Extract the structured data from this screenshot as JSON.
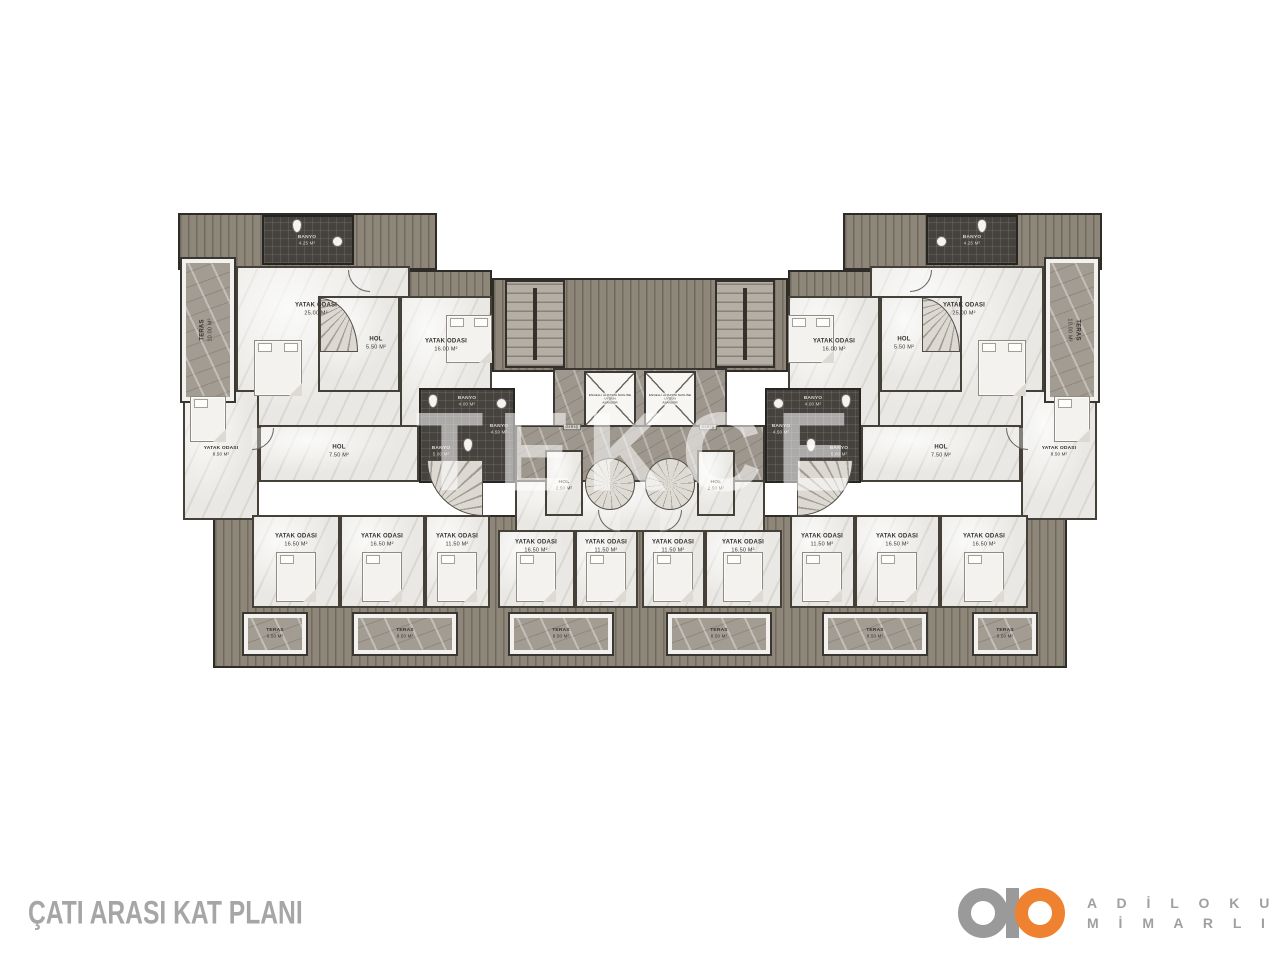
{
  "title": "ÇATI ARASI KAT PLANI",
  "watermark": "TEKCE",
  "logo": {
    "line1": "A D İ L O K U R",
    "line2": "M İ M A R L I K",
    "accent_color": "#EE8230",
    "gray_color": "#9A9A9A"
  },
  "plan": {
    "top": {
      "teras": {
        "name": "TERAS",
        "area": "10.00 M²"
      },
      "bedroom_big": {
        "name": "YATAK ODASI",
        "area": "25.00 M²"
      },
      "banyo": {
        "name": "BANYO",
        "area": "4.25 M²"
      },
      "hol": {
        "name": "HOL",
        "area": "5.50 M²"
      },
      "bedroom": {
        "name": "YATAK ODASI",
        "area": "16.00 M²"
      }
    },
    "mid": {
      "bedroom": {
        "name": "YATAK ODASI",
        "area": "8.50 M²"
      },
      "hol": {
        "name": "HOL",
        "area": "7.50 M²"
      },
      "banyo_top": {
        "name": "BANYO",
        "area": "4.00 M²"
      },
      "banyo_main": {
        "name": "BANYO",
        "area": "5.00 M²"
      },
      "banyo_small": {
        "name": "BANYO",
        "area": "4.50 M²"
      },
      "hol_small": {
        "name": "HOL",
        "area": "2.50 M²"
      }
    },
    "core": {
      "elevator": {
        "line1": "ENGELLİ ve HASTA NAKLİNE",
        "line2": "UYGUN",
        "line3": "ASANSÖR"
      },
      "giris": "GİRİŞ"
    },
    "bottom_rooms": [
      {
        "name": "YATAK ODASI",
        "area": "16.50 M²"
      },
      {
        "name": "YATAK ODASI",
        "area": "16.50 M²"
      },
      {
        "name": "YATAK ODASI",
        "area": "11.50 M²"
      },
      {
        "name": "YATAK ODASI",
        "area": "16.50 M²"
      },
      {
        "name": "YATAK ODASI",
        "area": "11.50 M²"
      },
      {
        "name": "YATAK ODASI",
        "area": "11.50 M²"
      },
      {
        "name": "YATAK ODASI",
        "area": "16.50 M²"
      },
      {
        "name": "YATAK ODASI",
        "area": "11.50 M²"
      },
      {
        "name": "YATAK ODASI",
        "area": "16.50 M²"
      },
      {
        "name": "YATAK ODASI",
        "area": "16.50 M²"
      }
    ],
    "terraces": [
      {
        "name": "TERAS",
        "area": "6.50 M²"
      },
      {
        "name": "TERAS",
        "area": "8.50 M²"
      },
      {
        "name": "TERAS",
        "area": "8.50 M²"
      },
      {
        "name": "TERAS",
        "area": "8.50 M²"
      },
      {
        "name": "TERAS",
        "area": "8.50 M²"
      },
      {
        "name": "TERAS",
        "area": "6.50 M²"
      }
    ]
  }
}
